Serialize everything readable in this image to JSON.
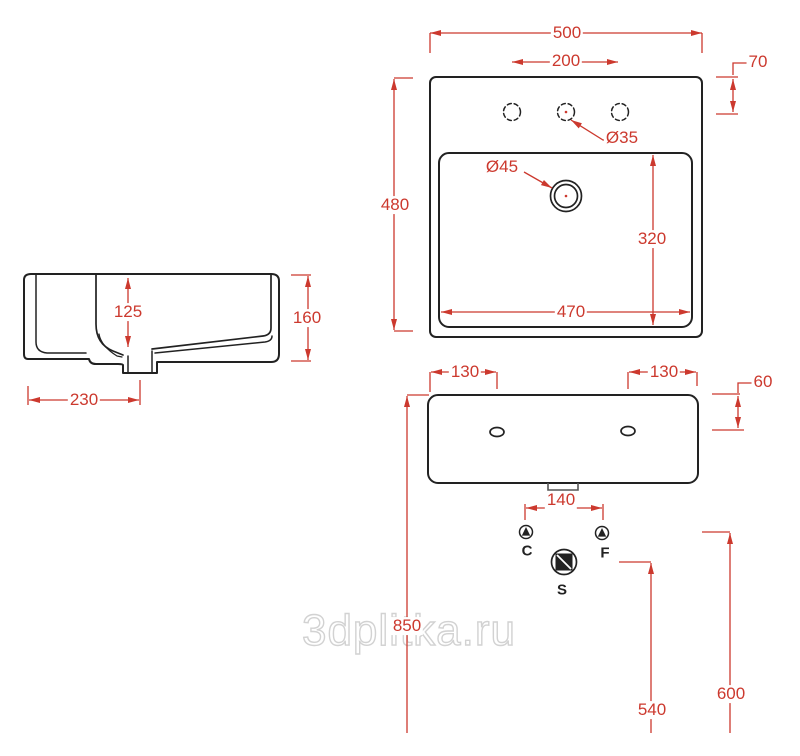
{
  "watermark": {
    "text": "3dplitka.ru"
  },
  "colors": {
    "dimension": "#cc392e",
    "line": "#222222",
    "watermark_outline": "#d2d2d2",
    "drain_tab": "#555555"
  },
  "dims": {
    "overall_width": "500",
    "faucet_hole_spacing": "200",
    "faucet_hole_back_offset": "70",
    "overall_depth": "480",
    "basin_length": "470",
    "basin_width": "320",
    "faucet_hole_diameter": "Ø35",
    "drain_diameter": "Ø45",
    "basin_depth": "125",
    "overall_height": "160",
    "drain_from_front": "230",
    "mount_hole_left_offset": "130",
    "mount_hole_right_offset": "130",
    "mount_hole_top_offset": "60",
    "supply_spacing": "140",
    "rim_height_from_floor": "850",
    "waste_height_from_floor": "540",
    "supply_height_from_floor": "600"
  },
  "symbols": {
    "cold_label": "C",
    "hot_label": "F",
    "waste_label": "S"
  }
}
